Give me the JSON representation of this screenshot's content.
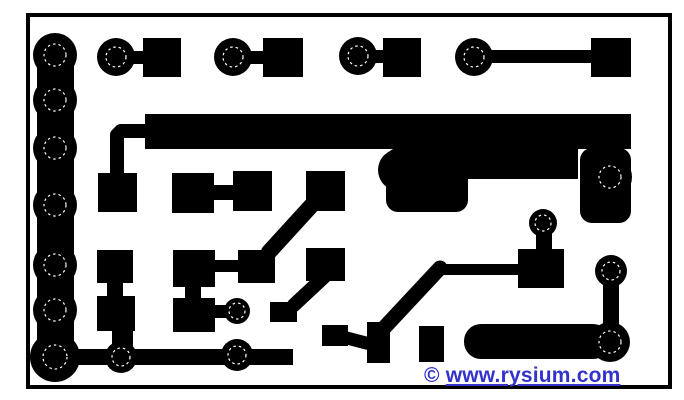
{
  "watermark": {
    "copyright": "©",
    "link_text": "www.rysium.com",
    "color": "#3333cc"
  },
  "artwork": {
    "background": "#ffffff",
    "copper": "#000000",
    "drill_color": "#ffffff",
    "frame": {
      "x": 28,
      "y": 15,
      "w": 642,
      "h": 372,
      "stroke_w": 4
    },
    "rects": [
      {
        "x": 37,
        "y": 55,
        "w": 37,
        "h": 302
      },
      {
        "x": 55,
        "y": 349,
        "w": 238,
        "h": 16
      },
      {
        "x": 112,
        "y": 51,
        "w": 34,
        "h": 13
      },
      {
        "x": 143,
        "y": 38,
        "w": 38,
        "h": 39
      },
      {
        "x": 231,
        "y": 51,
        "w": 35,
        "h": 13
      },
      {
        "x": 263,
        "y": 38,
        "w": 40,
        "h": 39
      },
      {
        "x": 355,
        "y": 50,
        "w": 31,
        "h": 13
      },
      {
        "x": 383,
        "y": 38,
        "w": 38,
        "h": 39
      },
      {
        "x": 470,
        "y": 50,
        "w": 123,
        "h": 13
      },
      {
        "x": 591,
        "y": 38,
        "w": 40,
        "h": 39
      },
      {
        "x": 145,
        "y": 114,
        "w": 486,
        "h": 35
      },
      {
        "x": 98,
        "y": 173,
        "w": 39,
        "h": 39
      },
      {
        "x": 172,
        "y": 173,
        "w": 42,
        "h": 40
      },
      {
        "x": 212,
        "y": 185,
        "w": 23,
        "h": 15
      },
      {
        "x": 233,
        "y": 171,
        "w": 39,
        "h": 40
      },
      {
        "x": 306,
        "y": 171,
        "w": 39,
        "h": 40
      },
      {
        "x": 386,
        "y": 148,
        "w": 82,
        "h": 64,
        "rx": 12
      },
      {
        "x": 456,
        "y": 148,
        "w": 122,
        "h": 31
      },
      {
        "x": 580,
        "y": 148,
        "w": 51,
        "h": 75,
        "rx": 12
      },
      {
        "x": 97,
        "y": 250,
        "w": 36,
        "h": 33
      },
      {
        "x": 107,
        "y": 283,
        "w": 16,
        "h": 14
      },
      {
        "x": 97,
        "y": 296,
        "w": 38,
        "h": 35
      },
      {
        "x": 112,
        "y": 331,
        "w": 21,
        "h": 22
      },
      {
        "x": 173,
        "y": 250,
        "w": 42,
        "h": 37
      },
      {
        "x": 214,
        "y": 260,
        "w": 26,
        "h": 12
      },
      {
        "x": 238,
        "y": 250,
        "w": 37,
        "h": 33
      },
      {
        "x": 185,
        "y": 287,
        "w": 16,
        "h": 12
      },
      {
        "x": 173,
        "y": 298,
        "w": 42,
        "h": 34
      },
      {
        "x": 213,
        "y": 305,
        "w": 18,
        "h": 13
      },
      {
        "x": 306,
        "y": 248,
        "w": 39,
        "h": 33
      },
      {
        "x": 270,
        "y": 302,
        "w": 27,
        "h": 20
      },
      {
        "x": 322,
        "y": 325,
        "w": 26,
        "h": 21
      },
      {
        "x": 367,
        "y": 322,
        "w": 23,
        "h": 41
      },
      {
        "x": 419,
        "y": 326,
        "w": 25,
        "h": 36
      },
      {
        "x": 518,
        "y": 249,
        "w": 46,
        "h": 39
      },
      {
        "x": 536,
        "y": 232,
        "w": 16,
        "h": 18
      },
      {
        "x": 437,
        "y": 264,
        "w": 83,
        "h": 11
      },
      {
        "x": 464,
        "y": 324,
        "w": 146,
        "h": 35,
        "rx": 17
      },
      {
        "x": 603,
        "y": 281,
        "w": 16,
        "h": 50
      }
    ],
    "lines": [
      {
        "pts": [
          [
            146,
            131
          ],
          [
            121,
            131
          ],
          [
            117,
            135
          ],
          [
            117,
            176
          ]
        ],
        "w": 14
      },
      {
        "pts": [
          [
            311,
            206
          ],
          [
            269,
            252
          ]
        ],
        "w": 16
      },
      {
        "pts": [
          [
            294,
            305
          ],
          [
            324,
            277
          ]
        ],
        "w": 14
      },
      {
        "pts": [
          [
            440,
            268
          ],
          [
            383,
            329
          ]
        ],
        "w": 15
      },
      {
        "pts": [
          [
            343,
            337
          ],
          [
            370,
            344
          ]
        ],
        "w": 13
      }
    ],
    "pads": [
      {
        "cx": 55,
        "cy": 55,
        "r": 22,
        "drill": 11
      },
      {
        "cx": 55,
        "cy": 100,
        "r": 22,
        "drill": 11
      },
      {
        "cx": 55,
        "cy": 148,
        "r": 22,
        "drill": 11
      },
      {
        "cx": 55,
        "cy": 205,
        "r": 22,
        "drill": 11
      },
      {
        "cx": 55,
        "cy": 265,
        "r": 22,
        "drill": 11
      },
      {
        "cx": 55,
        "cy": 310,
        "r": 22,
        "drill": 11
      },
      {
        "cx": 55,
        "cy": 357,
        "r": 25,
        "drill": 12
      },
      {
        "cx": 121,
        "cy": 357,
        "r": 16,
        "drill": 9
      },
      {
        "cx": 237,
        "cy": 355,
        "r": 16,
        "drill": 9
      },
      {
        "cx": 116,
        "cy": 57,
        "r": 19,
        "drill": 10
      },
      {
        "cx": 233,
        "cy": 57,
        "r": 19,
        "drill": 10
      },
      {
        "cx": 358,
        "cy": 56,
        "r": 19,
        "drill": 10
      },
      {
        "cx": 474,
        "cy": 57,
        "r": 19,
        "drill": 10
      },
      {
        "cx": 237,
        "cy": 311,
        "r": 13,
        "drill": 8
      },
      {
        "cx": 543,
        "cy": 223,
        "r": 14,
        "drill": 8
      },
      {
        "cx": 610,
        "cy": 177,
        "r": 22,
        "drill": 11
      },
      {
        "cx": 611,
        "cy": 271,
        "r": 16,
        "drill": 9
      },
      {
        "cx": 610,
        "cy": 342,
        "r": 20,
        "drill": 11
      },
      {
        "cx": 399,
        "cy": 170,
        "r": 21,
        "drill": 0
      }
    ]
  }
}
